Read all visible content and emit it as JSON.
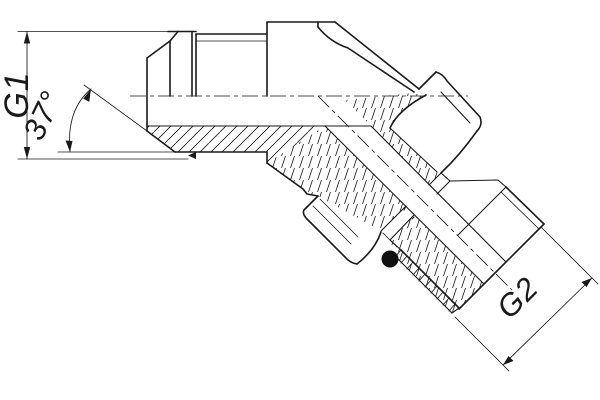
{
  "title": "45-degree flare elbow fitting drawing",
  "labels": {
    "g1": "G1",
    "angle": "37°",
    "g2": "G2"
  },
  "colors": {
    "line": "#1a1a1a",
    "background": "#ffffff",
    "oring": "#111111"
  },
  "features": {
    "o_ring": "black filled seal ring on 45-degree stud",
    "section_hatching": "45-degree and steep hatch on cut walls",
    "centerlines": "dash-dot axis lines"
  }
}
